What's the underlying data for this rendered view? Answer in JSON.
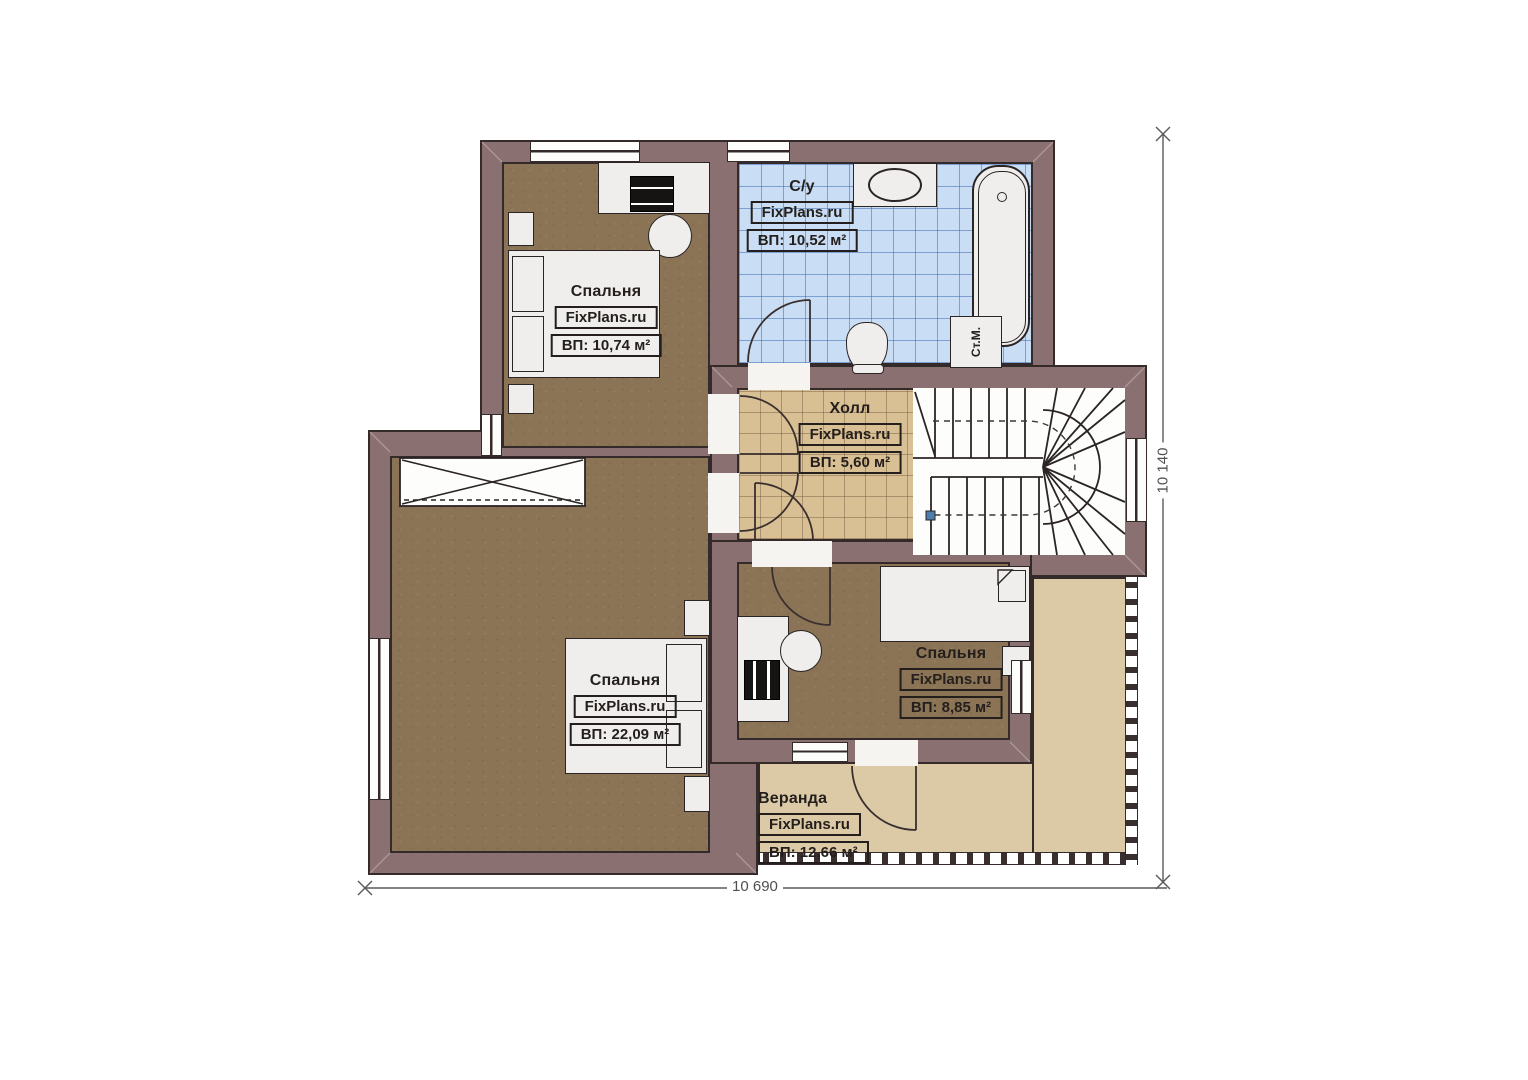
{
  "plan": {
    "title": "Second floor plan",
    "rooms": [
      {
        "id": "bedroom-1",
        "name": "Спальня",
        "brand": "FixPlans.ru",
        "area": "ВП: 10,74 м²"
      },
      {
        "id": "bathroom",
        "name": "С/у",
        "brand": "FixPlans.ru",
        "area": "ВП: 10,52 м²"
      },
      {
        "id": "hall",
        "name": "Холл",
        "brand": "FixPlans.ru",
        "area": "ВП: 5,60 м²"
      },
      {
        "id": "bedroom-2",
        "name": "Спальня",
        "brand": "FixPlans.ru",
        "area": "ВП: 22,09 м²"
      },
      {
        "id": "bedroom-3",
        "name": "Спальня",
        "brand": "FixPlans.ru",
        "area": "ВП: 8,85 м²"
      },
      {
        "id": "veranda",
        "name": "Веранда",
        "brand": "FixPlans.ru",
        "area": "ВП: 12,66 м²"
      }
    ],
    "appliances": {
      "washing_machine_label": "Ст.М."
    },
    "dimensions": {
      "bottom": "10 690",
      "right": "10 140"
    }
  },
  "colors": {
    "wall": "#8a7070",
    "outline": "#352a2a",
    "floor_wood": "#8b7456",
    "tile_tan": "#d9bf94",
    "tile_blue": "#c9def5",
    "veranda": "#dccaa7",
    "dimension": "#4f4f4f"
  }
}
